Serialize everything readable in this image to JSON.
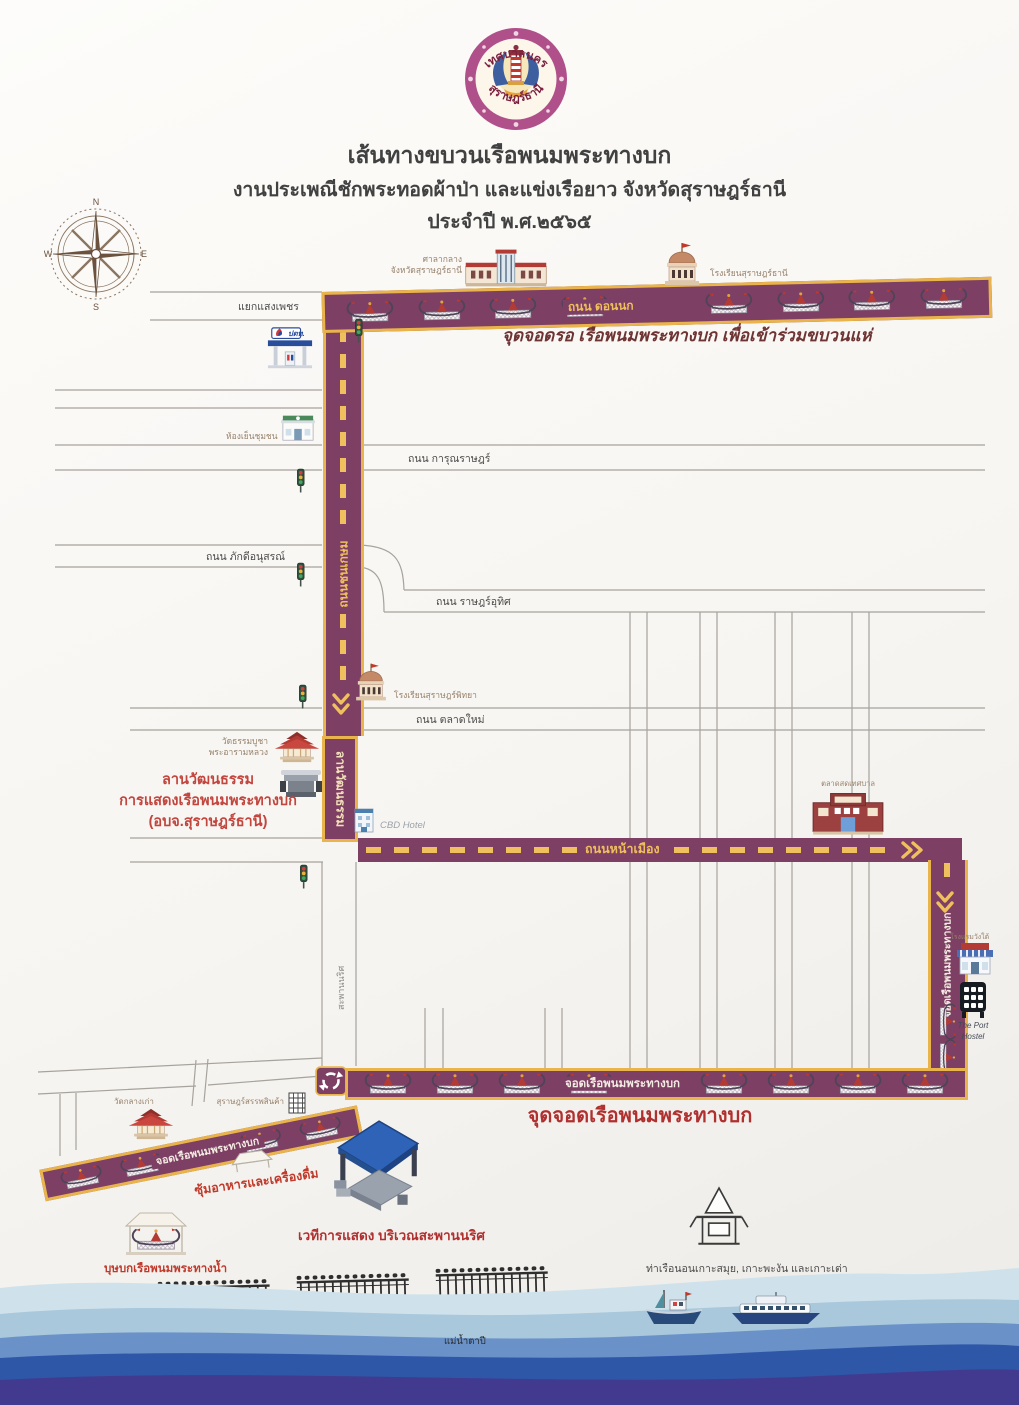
{
  "header": {
    "logo_top": "เทศบาลนคร",
    "logo_bottom": "สุราษฎร์ธานี",
    "title_line1": "เส้นทางขบวนเรือพนมพระทางบก",
    "title_line2": "งานประเพณีชักพระทอดผ้าป่า และแข่งเรือยาว จังหวัดสุราษฎร์ธานี",
    "title_line3": "ประจำปี พ.ศ.๒๕๖๕"
  },
  "compass": {
    "n": "N",
    "e": "E",
    "s": "S",
    "w": "W"
  },
  "route": {
    "donnok_road": "ถนน ดอนนก",
    "donnok_caption": "จุดจอดรอ เรือพนมพระทางบก เพื่อเข้าร่วมขบวนแห่",
    "chonkasem_road": "ถนนชนเกษม",
    "culture_lane": "ลานวัฒนธรรม",
    "namueang_road": "ถนนหน้าเมือง",
    "right_parking": "จอดเรือพนมพระทางบก",
    "bottom_parking": "จอดเรือพนมพระทางบก",
    "bottom_caption": "จุดจอดเรือพนมพระทางบก",
    "diagonal_parking": "จอดเรือพนมพระทางบก"
  },
  "streets": {
    "saengphet": "แยกแสงเพชร",
    "karunrat": "ถนน การุณราษฎร์",
    "phakdi": "ถนน ภักดีอนุสรณ์",
    "ratuthit": "ถนน ราษฎร์อุทิศ",
    "taladmai": "ถนน ตลาดใหม่",
    "naris": "สะพานนริศ"
  },
  "places": {
    "provincial_hall_line1": "ศาลากลาง",
    "provincial_hall_line2": "จังหวัดสุราษฎร์ธานี",
    "suratthani_school": "โรงเรียนสุราษฎร์ธานี",
    "ptt": "ปตท.",
    "community_store": "ห้องเย็นชุมชน",
    "suratpittaya_school": "โรงเรียนสุราษฎร์พิทยา",
    "wat_thammabucha_line1": "วัดธรรมบูชา",
    "wat_thammabucha_line2": "พระอารามหลวง",
    "culture_lawn_line1": "ลานวัฒนธรรม",
    "culture_lawn_line2": "การแสดงเรือพนมพระทางบก",
    "culture_lawn_line3": "(อบจ.สุราษฎร์ธานี)",
    "cbd_hotel": "CBD Hotel",
    "market": "ตลาดสดเทศบาล",
    "wangtai_hotel": "โรงแรมวังใต้",
    "port_hostel_line1": "The Port",
    "port_hostel_line2": "Hostel",
    "wat_klang_kao": "วัดกลางเก่า",
    "department_store": "สุราษฎร์สรรพสินค้า",
    "food_stalls": "ซุ้มอาหารและเครื่องดื่ม",
    "stage": "เวทีการแสดง บริเวณสะพานนริศ",
    "busabok": "บุษบกเรือพนมพระทางน้ำ",
    "pier": "ท่าเรือนอนเกาะสมุย, เกาะพะงัน และเกาะเต่า",
    "river": "แม่น้ำตาปี"
  },
  "colors": {
    "route_purple": "#7d3f63",
    "route_gold": "#e9b44c",
    "caption_red": "#b03030",
    "caption_maroon": "#6e3434"
  }
}
